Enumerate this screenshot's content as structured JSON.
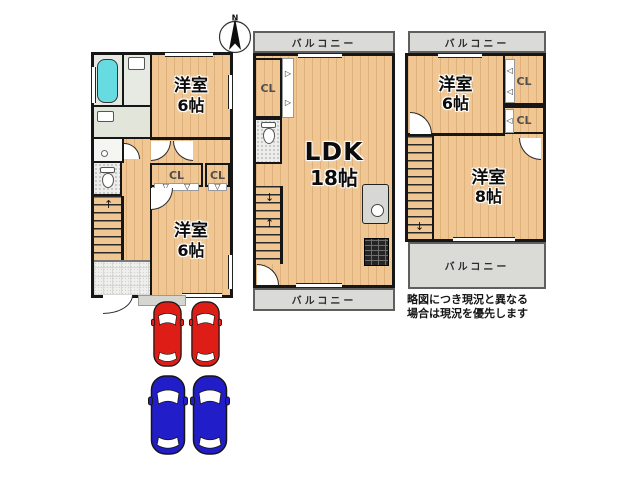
{
  "compass": {
    "label": "N"
  },
  "icons": {
    "north_arrow": "compass needle",
    "up": "↑",
    "down": "↓",
    "tri_down": "▽",
    "tri_right": "▷",
    "tri_left": "◁"
  },
  "plans": {
    "f1": {
      "bedroom_top": {
        "name": "洋室",
        "size": "6帖"
      },
      "bedroom_bottom": {
        "name": "洋室",
        "size": "6帖"
      },
      "closet_a": "CL",
      "closet_b": "CL"
    },
    "f2": {
      "balcony_top": "バルコニー",
      "balcony_bottom": "バルコニー",
      "ldk": {
        "name": "LDK",
        "size": "18帖"
      },
      "closet": "CL"
    },
    "f3": {
      "balcony_top": "バルコニー",
      "balcony_bottom": "バルコニー",
      "bedroom_top": {
        "name": "洋室",
        "size": "6帖"
      },
      "bedroom_bottom": {
        "name": "洋室",
        "size": "8帖"
      },
      "closet_a": "CL",
      "closet_b": "CL"
    }
  },
  "note": {
    "line1": "略図につき現況と異なる",
    "line2": "場合は現況を優先します"
  },
  "parking": {
    "cars": [
      {
        "color": "#dd1d16",
        "label": "red-car"
      },
      {
        "color": "#dd1d16",
        "label": "red-car"
      },
      {
        "color": "#211ec9",
        "label": "blue-car"
      },
      {
        "color": "#211ec9",
        "label": "blue-car"
      }
    ]
  },
  "colors": {
    "wood": "#f0c793",
    "balcony": "#dadad6",
    "bathtub": "#66dce2",
    "wall": "#161616",
    "car_red": "#dd1d16",
    "car_blue": "#211ec9"
  }
}
